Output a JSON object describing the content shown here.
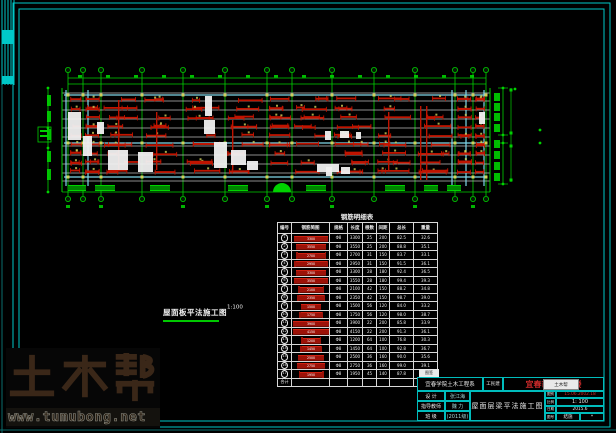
{
  "colors": {
    "frame": "#00c8c8",
    "frame_dim": "#0a6e6e",
    "grid_green": "#00d200",
    "beam": "#bdbdbd",
    "slab_cyan": "#7fd8ea",
    "rebar_red": "#c01400",
    "marker_yellow": "#cfcf5a",
    "white": "#f0f0f0",
    "red_text": "#cf2b2b",
    "watermark_brown": "#3a2718"
  },
  "frame": {
    "outer": [
      13,
      3,
      597,
      424
    ],
    "inner": [
      19,
      9,
      585,
      412
    ],
    "teal_x": 2,
    "teal_y": 430
  },
  "corner_strip": {
    "xs": [
      2,
      5,
      8,
      11,
      14
    ],
    "h": 85,
    "blocks": [
      [
        2,
        30,
        12,
        14
      ],
      [
        2,
        76,
        12,
        8
      ]
    ]
  },
  "plan": {
    "grid_x": [
      68,
      83,
      101,
      142,
      183,
      225,
      267,
      292,
      332,
      374,
      415,
      455,
      473,
      486
    ],
    "bubble_top_y": 70,
    "bubble_bot_y": 199,
    "beam_x0": 62,
    "beam_x1": 490,
    "beam_ys": [
      93,
      101,
      110,
      119,
      128,
      137,
      146,
      155,
      164,
      173,
      181
    ],
    "cyan_ys": [
      95,
      143,
      177
    ],
    "cyan_xs": [
      66,
      88,
      452,
      466,
      484
    ],
    "band_top": 88,
    "band_bot": 192,
    "top_dim_ys": [
      78,
      84
    ],
    "red_rows": [
      101,
      110,
      119,
      128,
      137,
      146,
      155,
      164,
      173
    ],
    "red_verticals": [
      [
        388,
        112,
        58
      ],
      [
        420,
        106,
        74
      ],
      [
        426,
        106,
        74
      ],
      [
        118,
        100,
        70
      ],
      [
        156,
        112,
        58
      ],
      [
        232,
        120,
        50
      ]
    ],
    "white_blobs": [
      [
        68,
        112,
        13,
        28
      ],
      [
        83,
        136,
        9,
        20
      ],
      [
        97,
        122,
        7,
        12
      ],
      [
        108,
        150,
        20,
        20
      ],
      [
        138,
        152,
        15,
        20
      ],
      [
        205,
        96,
        7,
        20
      ],
      [
        204,
        120,
        11,
        14
      ],
      [
        214,
        142,
        13,
        26
      ],
      [
        231,
        150,
        15,
        15
      ],
      [
        247,
        161,
        11,
        9
      ],
      [
        317,
        164,
        22,
        8
      ],
      [
        325,
        131,
        6,
        9
      ],
      [
        340,
        131,
        9,
        7
      ],
      [
        356,
        132,
        5,
        7
      ],
      [
        326,
        167,
        6,
        9
      ],
      [
        341,
        167,
        9,
        7
      ],
      [
        479,
        112,
        6,
        12
      ]
    ],
    "hatch_blocks": [
      [
        68,
        18
      ],
      [
        95,
        20
      ],
      [
        150,
        20
      ],
      [
        228,
        20
      ],
      [
        306,
        20
      ],
      [
        385,
        20
      ],
      [
        424,
        14
      ],
      [
        447,
        14
      ]
    ],
    "dome": [
      282,
      192,
      9
    ],
    "left_dim": {
      "line_x": 48,
      "text_x": 51,
      "text_ys": [
        95,
        111,
        129,
        151,
        169
      ],
      "box": [
        38,
        127,
        13,
        15
      ]
    },
    "right_dim": {
      "text_x": 494,
      "text_ys": [
        93,
        103,
        113,
        124,
        140,
        151,
        162,
        173
      ],
      "line1_x": 503,
      "dots1": [
        88,
        135,
        143,
        184
      ],
      "line2_x": 511,
      "squares": [
        90,
        133,
        146,
        180
      ],
      "far_dots": [
        [
          515,
          89
        ],
        [
          540,
          130
        ],
        [
          540,
          143
        ]
      ]
    }
  },
  "plan_label": {
    "text": "屋面板平法施工图",
    "scale": "1:100"
  },
  "table": {
    "title": "钢筋明细表",
    "headers": [
      "编号",
      "钢筋简图",
      "规格",
      "长度",
      "根数",
      "间距",
      "总长",
      "重量"
    ],
    "rows": [
      {
        "no": "1",
        "bar": {
          "w": 34,
          "hooks": false
        },
        "cells": [
          "Φ8",
          "3300",
          "25",
          "200",
          "82.5",
          "32.6"
        ]
      },
      {
        "no": "2",
        "bar": {
          "w": 30,
          "hooks": false
        },
        "cells": [
          "Φ8",
          "3550",
          "25",
          "200",
          "88.8",
          "35.1"
        ]
      },
      {
        "no": "3",
        "bar": {
          "w": 28,
          "hooks": true
        },
        "cells": [
          "Φ8",
          "2700",
          "31",
          "150",
          "83.7",
          "33.1"
        ]
      },
      {
        "no": "4",
        "bar": {
          "w": 32,
          "hooks": true
        },
        "cells": [
          "Φ8",
          "2950",
          "31",
          "150",
          "91.5",
          "36.1"
        ]
      },
      {
        "no": "5",
        "bar": {
          "w": 30,
          "hooks": false
        },
        "cells": [
          "Φ8",
          "3300",
          "28",
          "180",
          "92.4",
          "36.5"
        ]
      },
      {
        "no": "6",
        "bar": {
          "w": 34,
          "hooks": false
        },
        "cells": [
          "Φ8",
          "3550",
          "28",
          "180",
          "99.4",
          "39.3"
        ]
      },
      {
        "no": "7",
        "bar": {
          "w": 24,
          "hooks": true
        },
        "cells": [
          "Φ8",
          "2100",
          "42",
          "150",
          "88.2",
          "34.8"
        ]
      },
      {
        "no": "8",
        "bar": {
          "w": 26,
          "hooks": true
        },
        "cells": [
          "Φ8",
          "2350",
          "42",
          "150",
          "98.7",
          "39.0"
        ]
      },
      {
        "no": "9",
        "bar": {
          "w": 20,
          "hooks": false
        },
        "cells": [
          "Φ8",
          "1500",
          "56",
          "120",
          "84.0",
          "33.2"
        ]
      },
      {
        "no": "10",
        "bar": {
          "w": 22,
          "hooks": true
        },
        "cells": [
          "Φ8",
          "1750",
          "56",
          "120",
          "98.0",
          "38.7"
        ]
      },
      {
        "no": "11",
        "bar": {
          "w": 36,
          "hooks": false
        },
        "cells": [
          "Φ8",
          "3900",
          "22",
          "200",
          "85.8",
          "33.9"
        ]
      },
      {
        "no": "12",
        "bar": {
          "w": 36,
          "hooks": false
        },
        "cells": [
          "Φ8",
          "4150",
          "22",
          "200",
          "91.3",
          "36.1"
        ]
      },
      {
        "no": "13",
        "bar": {
          "w": 18,
          "hooks": true
        },
        "cells": [
          "Φ8",
          "1200",
          "64",
          "100",
          "76.8",
          "30.3"
        ]
      },
      {
        "no": "14",
        "bar": {
          "w": 20,
          "hooks": true
        },
        "cells": [
          "Φ8",
          "1450",
          "64",
          "100",
          "92.8",
          "36.7"
        ]
      },
      {
        "no": "15",
        "bar": {
          "w": 26,
          "hooks": false
        },
        "cells": [
          "Φ8",
          "2500",
          "36",
          "160",
          "90.0",
          "35.6"
        ]
      },
      {
        "no": "16",
        "bar": {
          "w": 28,
          "hooks": false
        },
        "cells": [
          "Φ8",
          "2750",
          "36",
          "160",
          "99.0",
          "39.1"
        ]
      },
      {
        "no": "17",
        "bar": {
          "w": 23,
          "hooks": true
        },
        "cells": [
          "Φ8",
          "1950",
          "45",
          "140",
          "87.8",
          "34.7"
        ]
      },
      {
        "no": "合计",
        "bar": null,
        "cells": [
          "",
          "",
          "",
          "",
          "",
          "595.8"
        ]
      }
    ]
  },
  "title_block": {
    "org": "宜春学院土木工程系",
    "dept": "工民建",
    "project": "宜春市某综合楼",
    "stamp": "土木帮",
    "note": "图签",
    "left_rows": [
      {
        "label": "设 计",
        "value": "张江海"
      },
      {
        "label": "指导教师",
        "value": "魏 力"
      },
      {
        "label": "班 级",
        "value": "(2011级)"
      }
    ],
    "drawing_title": "屋面层梁平法施工图",
    "right_rows": [
      {
        "label": "图别",
        "value": "15.06.2002.18"
      },
      {
        "label": "比例",
        "value": "1: 100"
      },
      {
        "label": "日期",
        "value": "2015.6"
      },
      {
        "label": "图号",
        "value": "结施",
        "extra": "*"
      }
    ]
  },
  "watermark": {
    "logo": "土木帮",
    "url": "www.tumubong.net"
  }
}
